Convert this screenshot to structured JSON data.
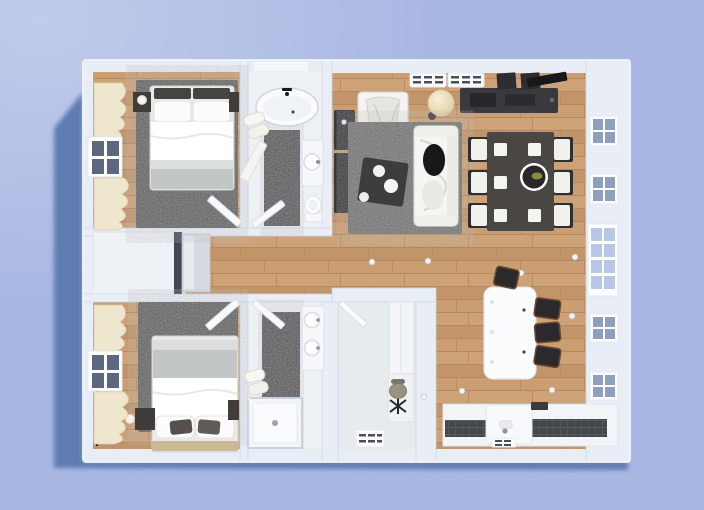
{
  "scene": {
    "description": "Top-down 3D render of a two-bedroom apartment floor plan casting a shadow on a periwinkle background",
    "colors": {
      "background": "#a9b8e3",
      "shadow": "#5e7bb1",
      "wall": "#e9edf5",
      "wall_edge": "#ccd6e9",
      "wood": "#c89d6f",
      "bedroom_rug": "#585858",
      "living_rug": "#6f6f6f",
      "bath_floor": "#eef1f4",
      "tile_strip": "#4b4b4f",
      "office_floor": "#e8ebee",
      "furniture_dark": "#3a3a3e",
      "dining_table": "#4a4643",
      "counter_dark": "#45484c",
      "cream_curtain": "#efe6ce",
      "white_furniture": "#f7f8fa",
      "window_pane_dark": "#5c6880",
      "window_pane_light": "#b9c7e6",
      "lamp_shade": "#f2e4c4"
    },
    "rooms": [
      {
        "name": "bedroom-top-left",
        "floor": "wood with dark area rug",
        "contents": [
          "double bed with white duvet and grey foot blanket",
          "dark headboard cushions",
          "two dark nightstands with white lamps",
          "cream curtains",
          "window on left wall",
          "inward swinging door"
        ]
      },
      {
        "name": "bathroom-top",
        "floor": "white tile with dark runner",
        "contents": [
          "oval bathtub with black faucet",
          "towel stack",
          "wall counter with round sink",
          "toilet",
          "door"
        ]
      },
      {
        "name": "living-dining-room",
        "floor": "wood planks",
        "contents": [
          "white sofa",
          "white armchair",
          "dark coffee table with white plates",
          "speckled grey rug",
          "globe floor lamp",
          "dark tv console with speakers",
          "two dark side cabinets",
          "dining table with six chairs and white placemats",
          "round centerpiece bowl",
          "two radiator grilles on top wall",
          "windows and balcony door on right wall",
          "ceiling spotlights"
        ]
      },
      {
        "name": "hallway",
        "floor": "wood planks",
        "contents": [
          "built-in closet block",
          "tall wardrobe with dark groove",
          "console with mirror panel"
        ]
      },
      {
        "name": "bedroom-bottom-left",
        "floor": "wood with dark area rug",
        "contents": [
          "double bed with headboard at bottom",
          "grey striped foot blanket",
          "dark accent pillows",
          "nightstands with lamps",
          "cream curtains",
          "window on left wall",
          "door"
        ]
      },
      {
        "name": "bathroom-bottom",
        "floor": "white tile with dark runner",
        "contents": [
          "double vanity with two round sinks",
          "glass shower enclosure",
          "towels",
          "door"
        ]
      },
      {
        "name": "office",
        "floor": "pale grey",
        "contents": [
          "white wardrobe",
          "small desk",
          "office swivel chair",
          "radiator grille",
          "door"
        ]
      },
      {
        "name": "kitchen",
        "floor": "wood planks",
        "contents": [
          "white island with rounded corners",
          "four dark bar stools",
          "counter run with dark worktops",
          "sink cabinet with faucet",
          "small dark cooktop",
          "plinth vent grille",
          "windows on right wall"
        ]
      }
    ]
  }
}
